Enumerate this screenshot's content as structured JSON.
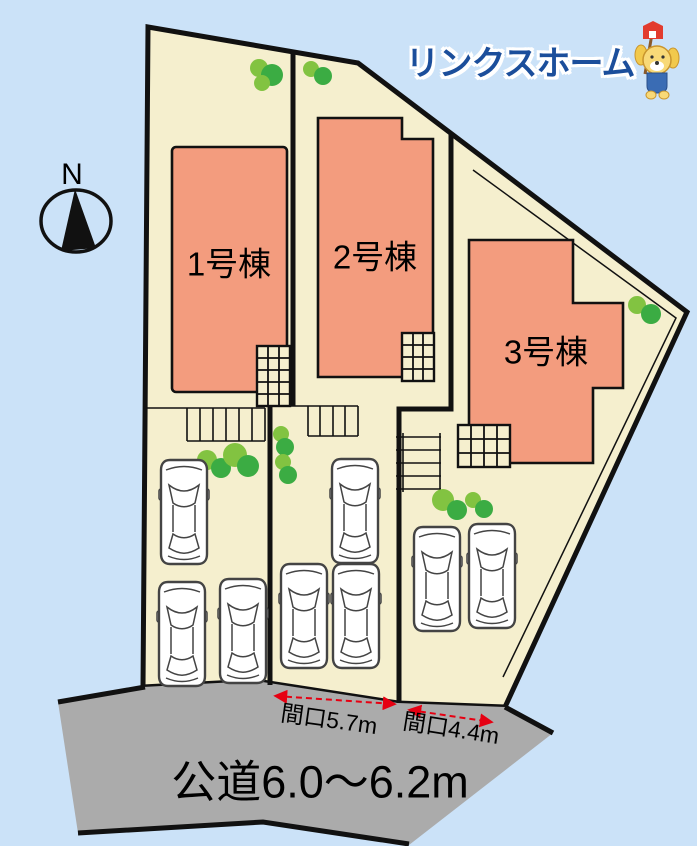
{
  "page": {
    "background_color": "#cbe2f8"
  },
  "logo": {
    "name": "リンクスホーム",
    "mascot": "puppy-with-flag-icon",
    "color": "#1b4e9b"
  },
  "compass": {
    "north_label": "N"
  },
  "plan": {
    "buildings": [
      {
        "id": 1,
        "label": "1号棟"
      },
      {
        "id": 2,
        "label": "2号棟"
      },
      {
        "id": 3,
        "label": "3号棟"
      }
    ],
    "frontages": [
      {
        "label": "間口5.7m"
      },
      {
        "label": "間口4.4m"
      }
    ],
    "road": {
      "label": "公道6.0〜6.2m"
    },
    "cars_drawn": 8,
    "tree_clusters_drawn": 6
  },
  "colors": {
    "site_fill": "#f5efce",
    "building_fill": "#f39c7e",
    "road_fill": "#ababab",
    "outline": "#111111",
    "tree_light": "#82c341",
    "tree_dark": "#3bac43",
    "arrow_red": "#e60012"
  }
}
